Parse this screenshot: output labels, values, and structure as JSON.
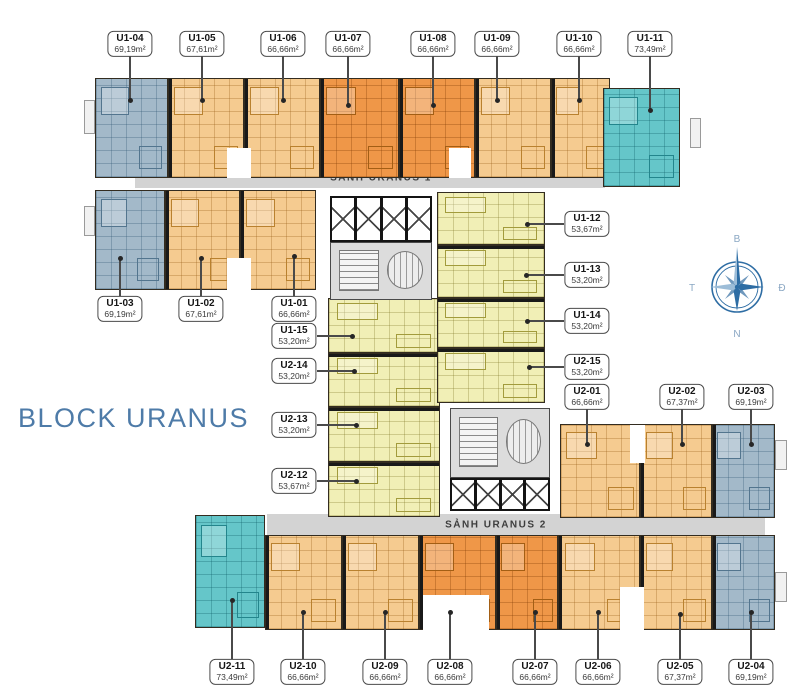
{
  "title": "BLOCK URANUS",
  "corridors": [
    {
      "name": "SẢNH URANUS 1",
      "rect": [
        135,
        168,
        470,
        20
      ],
      "text_cx": 381
    },
    {
      "name": "SẢNH URANUS 2",
      "rect": [
        267,
        514,
        498,
        21
      ],
      "text_cx": 496
    }
  ],
  "compass": {
    "labels": {
      "n": "B",
      "e": "Đ",
      "s": "N",
      "w": "T"
    },
    "color": "#2e6da4",
    "light_color": "#9dbdd8",
    "letter_color": "#8aa7c3"
  },
  "colors": {
    "blue_unit": "#a3b9c9",
    "light_orange_unit": "#f5cb90",
    "orange_unit": "#ef9748",
    "teal_unit": "#65c6c9",
    "yellow_unit": "#f1efb6",
    "corridor": "#d3d3d3",
    "title_text": "#4e7ba8"
  },
  "units": [
    {
      "id": "U1-04",
      "area": "69,19m²",
      "type": "blue",
      "rect": [
        95,
        78,
        73,
        100
      ],
      "wall": ""
    },
    {
      "id": "U1-05",
      "area": "67,61m²",
      "type": "lorange",
      "rect": [
        168,
        78,
        76,
        100
      ],
      "wall": "left"
    },
    {
      "id": "U1-06",
      "area": "66,66m²",
      "type": "lorange",
      "rect": [
        244,
        78,
        76,
        100
      ],
      "wall": "left"
    },
    {
      "id": "U1-07",
      "area": "66,66m²",
      "type": "orange",
      "rect": [
        320,
        78,
        79,
        100
      ],
      "wall": "left"
    },
    {
      "id": "U1-08",
      "area": "66,66m²",
      "type": "orange",
      "rect": [
        399,
        78,
        76,
        100
      ],
      "wall": "left"
    },
    {
      "id": "U1-09",
      "area": "66,66m²",
      "type": "lorange",
      "rect": [
        475,
        78,
        76,
        100
      ],
      "wall": "left"
    },
    {
      "id": "U1-10",
      "area": "66,66m²",
      "type": "lorange",
      "rect": [
        551,
        78,
        59,
        100
      ],
      "wall": "left"
    },
    {
      "id": "U1-11",
      "area": "73,49m²",
      "type": "teal",
      "rect": [
        603,
        88,
        77,
        99
      ],
      "wall": ""
    },
    {
      "id": "U1-03",
      "area": "69,19m²",
      "type": "blue",
      "rect": [
        95,
        190,
        70,
        100
      ],
      "wall": ""
    },
    {
      "id": "U1-02",
      "area": "67,61m²",
      "type": "lorange",
      "rect": [
        165,
        190,
        75,
        100
      ],
      "wall": "left"
    },
    {
      "id": "U1-01",
      "area": "66,66m²",
      "type": "lorange",
      "rect": [
        240,
        190,
        76,
        100
      ],
      "wall": "left"
    },
    {
      "id": "U1-15",
      "area": "53,20m²",
      "type": "yellow",
      "rect": [
        328,
        298,
        112,
        55
      ],
      "wall": ""
    },
    {
      "id": "U2-14",
      "area": "53,20m²",
      "type": "yellow",
      "rect": [
        328,
        353,
        112,
        54
      ],
      "wall": "top"
    },
    {
      "id": "U2-13",
      "area": "53,20m²",
      "type": "yellow",
      "rect": [
        328,
        407,
        112,
        55
      ],
      "wall": "top"
    },
    {
      "id": "U2-12",
      "area": "53,67m²",
      "type": "yellow",
      "rect": [
        328,
        462,
        112,
        55
      ],
      "wall": "top"
    },
    {
      "id": "U1-12",
      "area": "53,67m²",
      "type": "yellow",
      "rect": [
        437,
        192,
        108,
        53
      ],
      "wall": ""
    },
    {
      "id": "U1-13",
      "area": "53,20m²",
      "type": "yellow",
      "rect": [
        437,
        245,
        108,
        53
      ],
      "wall": "top"
    },
    {
      "id": "U1-14",
      "area": "53,20m²",
      "type": "yellow",
      "rect": [
        437,
        298,
        108,
        50
      ],
      "wall": "top"
    },
    {
      "id": "U2-15",
      "area": "53,20m²",
      "type": "yellow",
      "rect": [
        437,
        348,
        108,
        55
      ],
      "wall": "top"
    },
    {
      "id": "U2-01",
      "area": "66,66m²",
      "type": "lorange",
      "rect": [
        560,
        424,
        80,
        94
      ],
      "wall": ""
    },
    {
      "id": "U2-02",
      "area": "67,37m²",
      "type": "lorange",
      "rect": [
        640,
        424,
        72,
        94
      ],
      "wall": "left"
    },
    {
      "id": "U2-03",
      "area": "69,19m²",
      "type": "blue",
      "rect": [
        712,
        424,
        63,
        94
      ],
      "wall": "left"
    },
    {
      "id": "U2-11",
      "area": "73,49m²",
      "type": "teal",
      "rect": [
        195,
        515,
        70,
        113
      ],
      "wall": ""
    },
    {
      "id": "U2-10",
      "area": "66,66m²",
      "type": "lorange",
      "rect": [
        265,
        535,
        77,
        95
      ],
      "wall": "left"
    },
    {
      "id": "U2-09",
      "area": "66,66m²",
      "type": "lorange",
      "rect": [
        342,
        535,
        77,
        95
      ],
      "wall": "left"
    },
    {
      "id": "U2-08",
      "area": "66,66m²",
      "type": "orange",
      "rect": [
        419,
        535,
        77,
        95
      ],
      "wall": "left"
    },
    {
      "id": "U2-07",
      "area": "66,66m²",
      "type": "orange",
      "rect": [
        496,
        535,
        62,
        95
      ],
      "wall": "left"
    },
    {
      "id": "U2-06",
      "area": "66,66m²",
      "type": "lorange",
      "rect": [
        558,
        535,
        82,
        95
      ],
      "wall": "left"
    },
    {
      "id": "U2-05",
      "area": "67,37m²",
      "type": "lorange",
      "rect": [
        640,
        535,
        72,
        95
      ],
      "wall": "left"
    },
    {
      "id": "U2-04",
      "area": "69,19m²",
      "type": "blue",
      "rect": [
        712,
        535,
        63,
        95
      ],
      "wall": "left"
    }
  ],
  "labels": [
    {
      "id": "U1-04",
      "area": "69,19m²",
      "cx": 130,
      "cy": 44,
      "tx": 130,
      "ty": 100
    },
    {
      "id": "U1-05",
      "area": "67,61m²",
      "cx": 202,
      "cy": 44,
      "tx": 202,
      "ty": 100
    },
    {
      "id": "U1-06",
      "area": "66,66m²",
      "cx": 283,
      "cy": 44,
      "tx": 283,
      "ty": 100
    },
    {
      "id": "U1-07",
      "area": "66,66m²",
      "cx": 348,
      "cy": 44,
      "tx": 348,
      "ty": 105
    },
    {
      "id": "U1-08",
      "area": "66,66m²",
      "cx": 433,
      "cy": 44,
      "tx": 433,
      "ty": 105
    },
    {
      "id": "U1-09",
      "area": "66,66m²",
      "cx": 497,
      "cy": 44,
      "tx": 497,
      "ty": 100
    },
    {
      "id": "U1-10",
      "area": "66,66m²",
      "cx": 579,
      "cy": 44,
      "tx": 579,
      "ty": 100
    },
    {
      "id": "U1-11",
      "area": "73,49m²",
      "cx": 650,
      "cy": 44,
      "tx": 650,
      "ty": 110
    },
    {
      "id": "U1-03",
      "area": "69,19m²",
      "cx": 120,
      "cy": 309,
      "tx": 120,
      "ty": 258
    },
    {
      "id": "U1-02",
      "area": "67,61m²",
      "cx": 201,
      "cy": 309,
      "tx": 201,
      "ty": 258
    },
    {
      "id": "U1-01",
      "area": "66,66m²",
      "cx": 294,
      "cy": 309,
      "tx": 294,
      "ty": 256
    },
    {
      "id": "U1-15",
      "area": "53,20m²",
      "cx": 294,
      "cy": 336,
      "tx": 352,
      "ty": 336
    },
    {
      "id": "U2-14",
      "area": "53,20m²",
      "cx": 294,
      "cy": 371,
      "tx": 354,
      "ty": 371
    },
    {
      "id": "U2-13",
      "area": "53,20m²",
      "cx": 294,
      "cy": 425,
      "tx": 356,
      "ty": 425
    },
    {
      "id": "U2-12",
      "area": "53,67m²",
      "cx": 294,
      "cy": 481,
      "tx": 356,
      "ty": 481
    },
    {
      "id": "U1-12",
      "area": "53,67m²",
      "cx": 587,
      "cy": 224,
      "tx": 527,
      "ty": 224
    },
    {
      "id": "U1-13",
      "area": "53,20m²",
      "cx": 587,
      "cy": 275,
      "tx": 526,
      "ty": 275
    },
    {
      "id": "U1-14",
      "area": "53,20m²",
      "cx": 587,
      "cy": 321,
      "tx": 527,
      "ty": 321
    },
    {
      "id": "U2-15",
      "area": "53,20m²",
      "cx": 587,
      "cy": 367,
      "tx": 529,
      "ty": 367
    },
    {
      "id": "U2-01",
      "area": "66,66m²",
      "cx": 587,
      "cy": 397,
      "tx": 587,
      "ty": 444
    },
    {
      "id": "U2-02",
      "area": "67,37m²",
      "cx": 682,
      "cy": 397,
      "tx": 682,
      "ty": 444
    },
    {
      "id": "U2-03",
      "area": "69,19m²",
      "cx": 751,
      "cy": 397,
      "tx": 751,
      "ty": 444
    },
    {
      "id": "U2-11",
      "area": "73,49m²",
      "cx": 232,
      "cy": 672,
      "tx": 232,
      "ty": 600
    },
    {
      "id": "U2-10",
      "area": "66,66m²",
      "cx": 303,
      "cy": 672,
      "tx": 303,
      "ty": 612
    },
    {
      "id": "U2-09",
      "area": "66,66m²",
      "cx": 385,
      "cy": 672,
      "tx": 385,
      "ty": 612
    },
    {
      "id": "U2-08",
      "area": "66,66m²",
      "cx": 450,
      "cy": 672,
      "tx": 450,
      "ty": 612
    },
    {
      "id": "U2-07",
      "area": "66,66m²",
      "cx": 535,
      "cy": 672,
      "tx": 535,
      "ty": 612
    },
    {
      "id": "U2-06",
      "area": "66,66m²",
      "cx": 598,
      "cy": 672,
      "tx": 598,
      "ty": 612
    },
    {
      "id": "U2-05",
      "area": "67,37m²",
      "cx": 680,
      "cy": 672,
      "tx": 680,
      "ty": 614
    },
    {
      "id": "U2-04",
      "area": "69,19m²",
      "cx": 751,
      "cy": 672,
      "tx": 751,
      "ty": 612
    }
  ],
  "elevator_banks": [
    {
      "rect": [
        330,
        196,
        102,
        46
      ],
      "cells": 4
    },
    {
      "rect": [
        450,
        478,
        100,
        33
      ],
      "cells": 4
    }
  ],
  "stair_cores": [
    {
      "rect": [
        330,
        242,
        102,
        58
      ]
    },
    {
      "rect": [
        450,
        408,
        100,
        70
      ]
    }
  ],
  "notches": [
    [
      227,
      148,
      24,
      30
    ],
    [
      449,
      148,
      22,
      30
    ],
    [
      227,
      258,
      24,
      32
    ],
    [
      423,
      595,
      66,
      35
    ],
    [
      620,
      587,
      24,
      43
    ],
    [
      630,
      425,
      15,
      38
    ]
  ],
  "balconies": [
    [
      84,
      100,
      11,
      34
    ],
    [
      84,
      206,
      11,
      30
    ],
    [
      690,
      118,
      11,
      30
    ],
    [
      775,
      440,
      12,
      30
    ],
    [
      775,
      572,
      12,
      30
    ]
  ]
}
